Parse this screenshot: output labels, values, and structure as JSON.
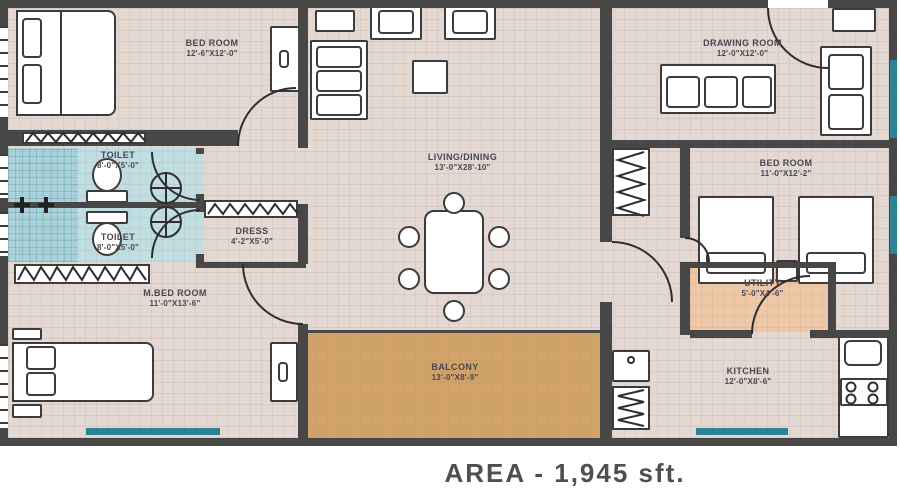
{
  "footer": {
    "area_label": "AREA - 1,945 sft."
  },
  "colors": {
    "wall": "#474747",
    "floor": "#e3d8d2",
    "toilet_tile": "#c0dde2",
    "shower_tile": "#a9d3dc",
    "balcony_floor": "#d1a368",
    "utility_floor": "#eec7a7",
    "window_glass": "#2e8296",
    "label_text": "#474752"
  },
  "rooms": {
    "bedroom1": {
      "name": "BED ROOM",
      "dims": "12'-6\"X12'-0\""
    },
    "drawing": {
      "name": "DRAWING ROOM",
      "dims": "12'-0\"X12'-0\""
    },
    "toilet1": {
      "name": "TOILET",
      "dims": "8'-0\"X5'-0\""
    },
    "toilet2": {
      "name": "TOILET",
      "dims": "8'-0\"X5'-0\""
    },
    "living": {
      "name": "LIVING/DINING",
      "dims": "13'-0\"X28'-10\""
    },
    "bedroom2": {
      "name": "BED ROOM",
      "dims": "11'-0\"X12'-2\""
    },
    "dress": {
      "name": "DRESS",
      "dims": "4'-2\"X5'-0\""
    },
    "mbedroom": {
      "name": "M.BED ROOM",
      "dims": "11'-0\"X13'-6\""
    },
    "utility": {
      "name": "UTILITY",
      "dims": "5'-0\"X4'-6\""
    },
    "balcony": {
      "name": "BALCONY",
      "dims": "13'-0\"X8'-9\""
    },
    "kitchen": {
      "name": "KITCHEN",
      "dims": "12'-0\"X8'-6\""
    }
  }
}
